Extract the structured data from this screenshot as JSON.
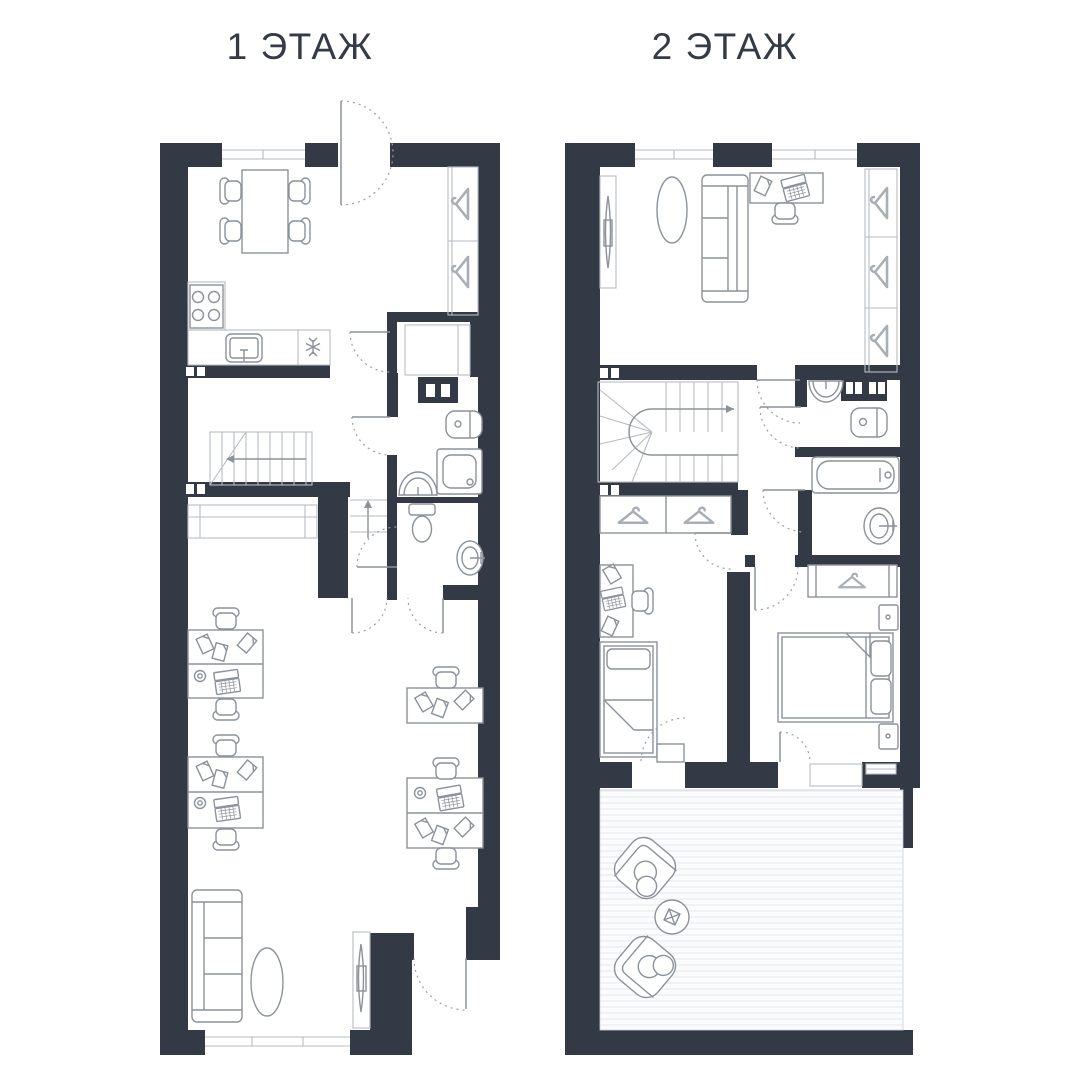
{
  "page": {
    "background": "#FFFFFF"
  },
  "floor1": {
    "title": "1 ЭТАЖ",
    "icons": [
      "entrance-door-swing-icon",
      "window-icon",
      "dining-table-icon",
      "chair-icon",
      "stove-icon",
      "kitchen-sink-icon",
      "snowflake-icon",
      "wardrobe-hanger-icon",
      "vent-icon",
      "staircase-icon",
      "direction-arrow-icon",
      "storage-closet-icon",
      "washing-machine-icon",
      "shower-icon",
      "bathroom-sink-icon",
      "toilet-icon",
      "cabinet-icon",
      "office-desk-icon",
      "office-chair-icon",
      "laptop-icon",
      "paper-icon",
      "phone-icon",
      "sofa-icon",
      "rug-icon",
      "tv-icon",
      "door-swing-icon"
    ]
  },
  "floor2": {
    "title": "2 ЭТАЖ",
    "icons": [
      "window-icon",
      "tv-icon",
      "rug-icon",
      "sofa-icon",
      "desk-icon",
      "office-chair-icon",
      "laptop-icon",
      "paper-icon",
      "wardrobe-hanger-icon",
      "staircase-icon",
      "direction-arrow-icon",
      "vent-icon",
      "bathroom-sink-icon",
      "washing-machine-icon",
      "bathtub-icon",
      "single-bed-icon",
      "double-bed-icon",
      "nightstand-icon",
      "terrace-deck-icon",
      "armchair-icon",
      "coffee-table-icon",
      "door-swing-icon"
    ]
  },
  "colors": {
    "wall": "#333A45",
    "furniture_line": "#8B929B",
    "light_line": "#B6BCC4",
    "hanger_line": "#A9AFB7",
    "door_arc": "#9AA0A8",
    "deck_stripe": "#E8EBEF",
    "title_text": "#343B46",
    "background": "#FFFFFF"
  }
}
